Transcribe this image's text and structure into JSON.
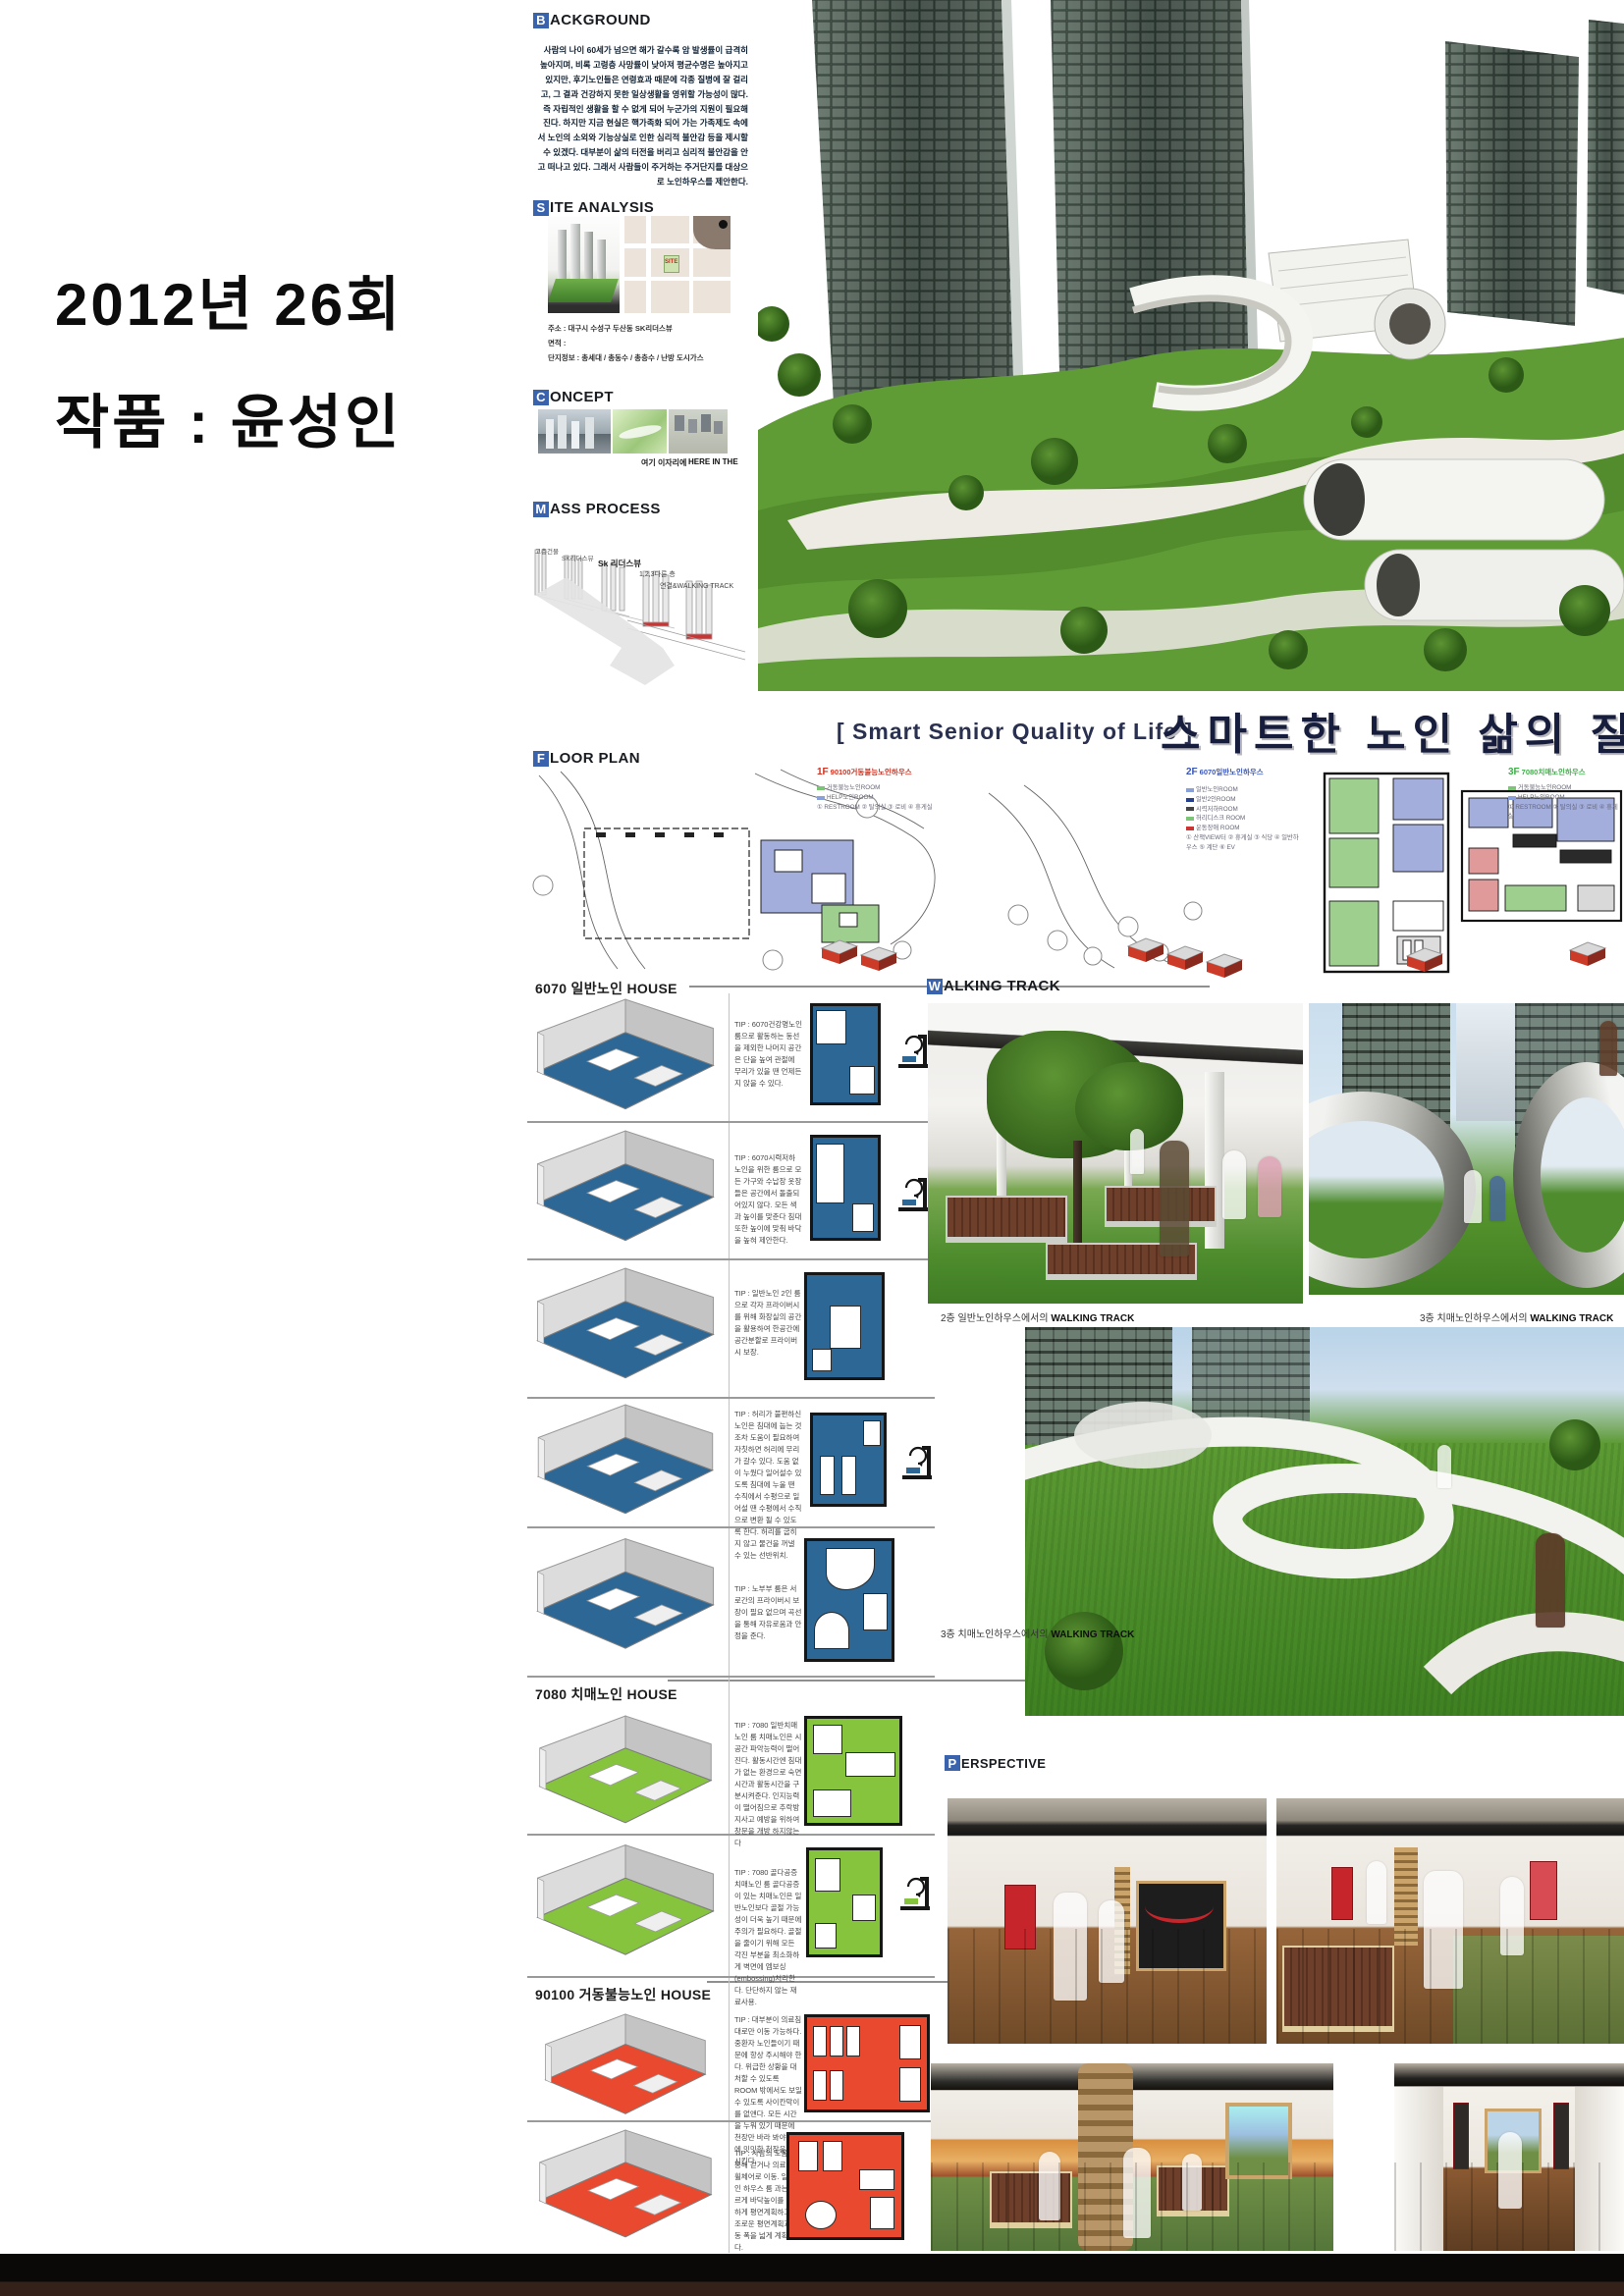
{
  "title_block": {
    "line1": "2012년 26회",
    "line2": "작품 : 윤성인"
  },
  "headers": {
    "background": {
      "cap": "B",
      "rest": "ACKGROUND"
    },
    "site_analysis": {
      "cap": "S",
      "rest": "ITE ANALYSIS"
    },
    "concept": {
      "cap": "C",
      "rest": "ONCEPT"
    },
    "mass_process": {
      "cap": "M",
      "rest": "ASS PROCESS"
    },
    "floor_plan": {
      "cap": "F",
      "rest": "LOOR PLAN"
    },
    "walking_track": {
      "cap": "W",
      "rest": "ALKING TRACK"
    },
    "perspective": {
      "cap": "P",
      "rest": "ERSPECTIVE"
    }
  },
  "background": {
    "body": "사람의 나이 60세가 넘으면 해가 갈수록 암 발생률이 급격히 높아지며, 비록 고령층 사망률이 낮아져 평균수명은 높아지고 있지만, 후기노인들은 연령효과 때문에 각종 질병에 잘 걸리고, 그 결과 건강하지 못한 일상생활을 영위할 가능성이 많다. 즉 자립적인 생활을 할 수 없게 되어 누군가의 지원이 필요해진다. 하지만 지금 현실은 핵가족화 되어 가는 가족제도 속에서 노인의 소외와 기능상실로 인한 심리적 불안감 등을 제시할 수 있겠다. 대부분이 삶의 터전을 버리고 심리적 불안감을 안고 떠나고 있다. 그래서 사람들이 주거하는 주거단지를 대상으로 노인하우스를 제안한다."
  },
  "site_analysis": {
    "address": "주소 : 대구시 수성구 두산동 SK리더스뷰",
    "area": "면적 :",
    "complex_info": "단지정보 : 총세대 / 총동수 / 총층수 / 난방 도시가스",
    "map_marker": "SITE"
  },
  "concept": {
    "caption_ko": "여기 이자리에",
    "caption_en": "HERE IN THE"
  },
  "mass_process": {
    "labels": [
      "고층건물",
      "SK리더스뷰",
      "Sk 리더스뷰",
      "1,2,3다른 층",
      "연결&WALKING TRACK"
    ]
  },
  "main_title": {
    "en": "[ Smart Senior Quality of Life ]",
    "ko": "스마트한 노인 삶의 질"
  },
  "floor_plans": [
    {
      "no": "1F",
      "name": "90100거동불능노인하우스",
      "label_color": "#cc3322",
      "legend": [
        "거동불능노인ROOM",
        "HELP노인ROOM",
        "① RESTROOM  ② 탈의실  ③ 로비  ④ 휴게실"
      ]
    },
    {
      "no": "2F",
      "name": "6070일반노인하우스",
      "label_color": "#3a56b4",
      "legend": [
        "일반노인ROOM",
        "일반2인ROOM",
        "시력저하ROOM",
        "허리디스크 ROOM",
        "운동장애 ROOM",
        "① 산책VIEW터 ② 휴게실 ③ 식당 ④ 일반하우스 ⑤ 계단 ⑥ EV"
      ]
    },
    {
      "no": "3F",
      "name": "7080치매노인하우스",
      "label_color": "#3fae49",
      "legend": [
        "거동불능노인ROOM",
        "HELP노인ROOM",
        "① RESTROOM  ② 탈의실  ③ 로비  ④ 휴게실"
      ]
    }
  ],
  "house_sections": [
    {
      "title": "6070 일반노인 HOUSE",
      "rows": [
        {
          "tip": "TIP : 6070건강명노인 룸으로 활동하는 동선을 제외한 나머지 공간은 단을 높여 관절에 무리가 있을 땐 언제든지 앉을 수 있다."
        },
        {
          "tip": "TIP : 6070시력저하 노인을 위한 룸으로 모든 가구와 수납장 옷장들은 공간에서 돌출되어있지 않다. 모든 색과 높이를 맞춘다 침대 또한 높이에 맞춰 바닥을 높혀 제안한다."
        },
        {
          "tip": "TIP : 일반노인 2인 룸으로 각자 프라이버시를 위해 화장실의 공간을 활용하여 한공간에 공간분할로 프라이버시 보장."
        },
        {
          "tip": "TIP : 허리가 불편하신 노인은 침대에 눕는 것 조차 도움이 필요하여 자칫하면 허리에 무리가 갈수 있다. 도움 없이 누웠다 일어설수 있도록 침대에 누울 땐 수직에서 수평으로 일어설 땐 수평에서 수직으로 변환 될 수 있도록 한다. 허리를 굽히지 않고 물건을 꺼낼 수 있는 선반위치."
        },
        {
          "tip": "TIP : 노부부 룸은 서로간의 프라이버시 보장이 필요 없으며 곡선을 통해 자유로움과 안정을 준다."
        }
      ]
    },
    {
      "title": "7080 치매노인 HOUSE",
      "rows": [
        {
          "tip": "TIP : 7080 일반치매노인 룸 치매노인은 시공간 파악능력이 떨어진다. 활동시간엔 침대가 없는 환경으로 숙면시간과 활동시간을 구분시켜준다. 인지능력이 떨어짐으로 추락방지사고 예방을 위하여 창문을 개방 하지않는다"
        },
        {
          "tip": "TIP : 7080 골다공증 치매노인 룸 골다공증이 있는 치매노인은 일반노인보다 골절 가능성이 더욱 높기 때문에 주의가 필요하다. 골절을 줄이기 위해 모든 각진 부분을 최소화하게 벽면에 엠보싱(embossing)처리한다. 단단하지 않는 재료사용."
        }
      ]
    },
    {
      "title": "90100 거동불능노인 HOUSE",
      "rows": [
        {
          "tip": "TIP : 대부분이 의료침대로만 이동 가능하다. 중환자 노인들이기 때문에 항상 주시해야 한다. 위급한 상황을 대처할 수 있도록 ROOM 밖에서도 보일 수 있도록 사이칸막이를 없앤다. 모든 시간을 누워 있기 때문에 천장만 바라 봐야 하기에 밋밋한 천장을 모던 시킨다."
        },
        {
          "tip": "TIP : 사람의 도움을 통해 걷거나 의료침대/휠체어로 이동. 일반노인 하우스 룸 과는 다르게 바닥높이를 일정하게 평면계획하고 단조로운 평면계획과 이동 폭을 넓게 계획한다."
        }
      ]
    }
  ],
  "walking_track": {
    "caption_left_ko": "2층 일반노인하우스에서의",
    "caption_left_en": "WALKING TRACK",
    "caption_right_ko": "3층 치매노인하우스에서의",
    "caption_right_en": "WALKING TRACK",
    "caption_bottom_ko": "3층 치매노인하우스에서의",
    "caption_bottom_en": "WALKING TRACK"
  },
  "colors": {
    "header_cap_blue": "#3a63ae",
    "title_navy": "#171d3c",
    "unit_blue": "#2d6795",
    "unit_green": "#86c43d",
    "unit_red": "#e8492f",
    "label_red": "#cc3322",
    "label_blue": "#3a56b4",
    "label_green": "#3fae49",
    "grass_green": "#4e8c2e",
    "footer_brown": "#33211a"
  }
}
